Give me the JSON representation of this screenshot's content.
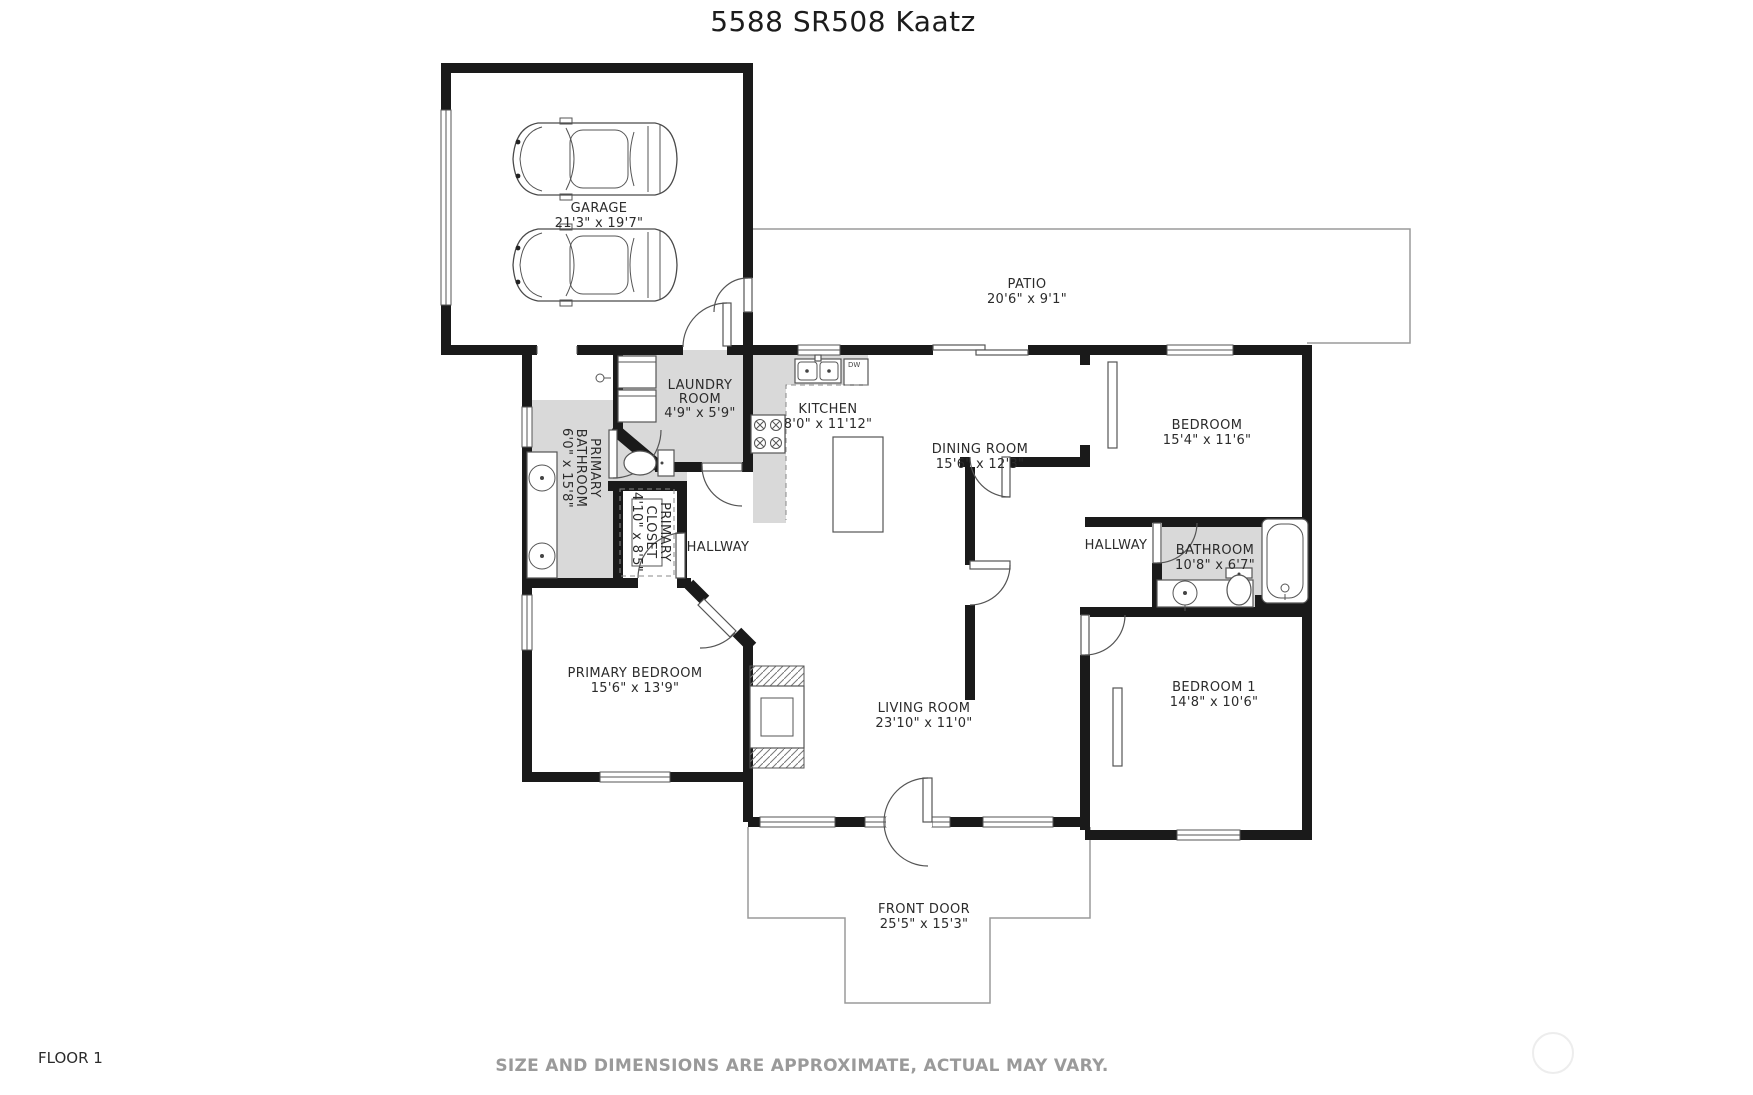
{
  "title": "5588 SR508 Kaatz",
  "footer": {
    "floor_label": "FLOOR 1",
    "disclaimer": "SIZE AND DIMENSIONS ARE APPROXIMATE, ACTUAL MAY VARY."
  },
  "rooms": {
    "garage": {
      "name": "GARAGE",
      "dims": "21'3\" x 19'7\""
    },
    "patio": {
      "name": "PATIO",
      "dims": "20'6\" x 9'1\""
    },
    "laundry": {
      "name_line1": "LAUNDRY",
      "name_line2": "ROOM",
      "dims": "4'9\" x 5'9\""
    },
    "kitchen": {
      "name": "KITCHEN",
      "dims": "8'0\" x 11'12\""
    },
    "dining_room": {
      "name": "DINING ROOM",
      "dims": "15'6\" x 12'3\""
    },
    "bedroom_top": {
      "name": "BEDROOM",
      "dims": "15'4\" x 11'6\""
    },
    "primary_bathroom": {
      "name_line1": "PRIMARY",
      "name_line2": "BATHROOM",
      "dims": "6'0\" x 15'8\""
    },
    "primary_closet": {
      "name_line1": "PRIMARY",
      "name_line2": "CLOSET",
      "dims": "4'10\" x 8'5\""
    },
    "hallway_left": {
      "name": "HALLWAY"
    },
    "hallway_right": {
      "name": "HALLWAY"
    },
    "bathroom": {
      "name": "BATHROOM",
      "dims": "10'8\" x 6'7\""
    },
    "primary_bedroom": {
      "name": "PRIMARY BEDROOM",
      "dims": "15'6\" x 13'9\""
    },
    "living_room": {
      "name": "LIVING ROOM",
      "dims": "23'10\" x 11'0\""
    },
    "bedroom_1": {
      "name": "BEDROOM 1",
      "dims": "14'8\" x 10'6\""
    },
    "front_door": {
      "name": "FRONT DOOR",
      "dims": "25'5\" x 15'3\""
    }
  },
  "fixtures": {
    "dishwasher_label": "DW"
  },
  "colors": {
    "wall": "#1a1a1a",
    "wet_room_fill": "#d9d9d9",
    "thin_line": "#9a9a9a",
    "disclaimer_text": "#9a9a9a"
  }
}
